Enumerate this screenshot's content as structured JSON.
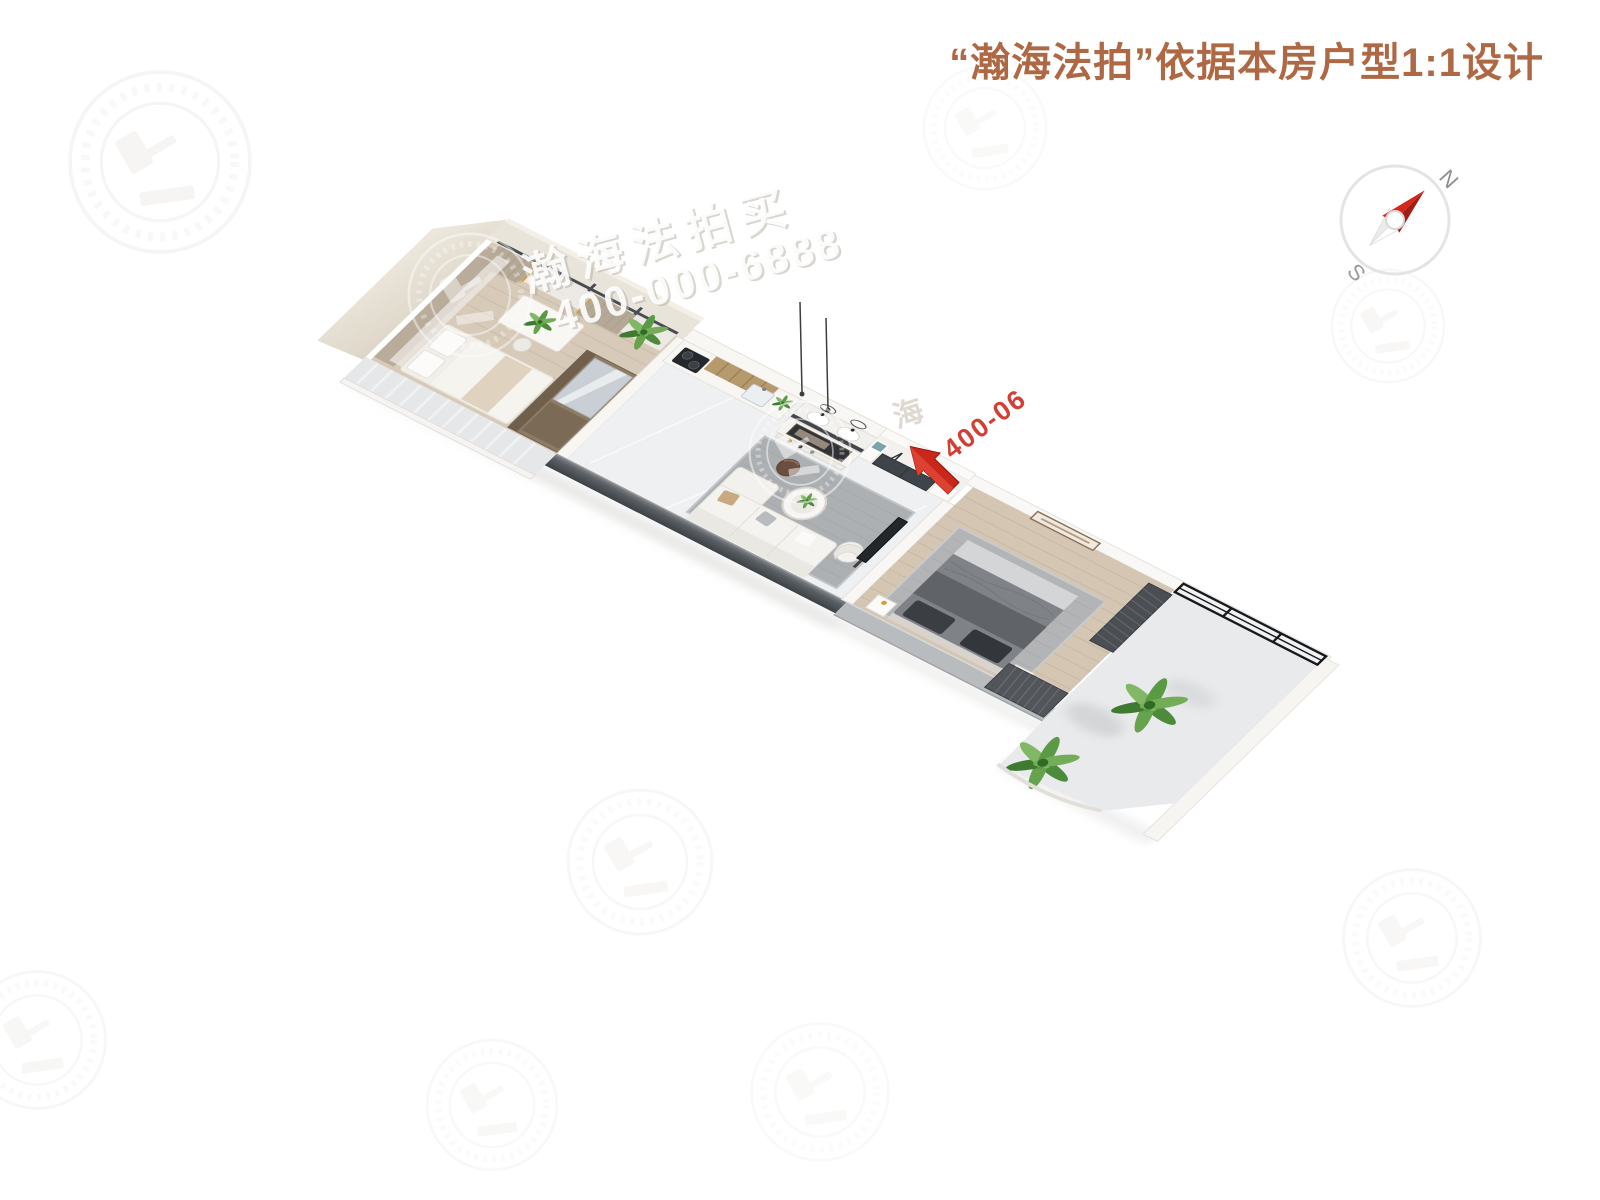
{
  "header": {
    "title": "“瀚海法拍”依据本房户型1:1设计",
    "title_color": "#AE6843"
  },
  "compass": {
    "north": "N",
    "south": "S",
    "needle_color": "#C9271A",
    "ring_color": "#E4E4E3"
  },
  "watermark": {
    "brand": "瀚海法拍买",
    "phone": "400-000-6888",
    "brand_fragment": "海",
    "phone_fragment": "400-06",
    "logo": "gavel-laurel-emblem"
  },
  "entrance_arrow": {
    "color": "#CB2418",
    "direction": "down-left",
    "meaning": "entrance"
  },
  "floorplan": {
    "view": "3d-top-down-render-rotated",
    "rooms": [
      "den-bedroom",
      "kitchen",
      "bathroom-vanity",
      "living-room",
      "entry-hall",
      "master-bedroom",
      "balcony"
    ],
    "palette": {
      "exterior_wall": "#E9E4DA",
      "dark_wall": "#4A4F54",
      "wood_floor": "#D8CAB9",
      "marble_floor": "#EEF0F2",
      "rug": "#AEB1B3",
      "plant_green": "#5E9448"
    }
  }
}
